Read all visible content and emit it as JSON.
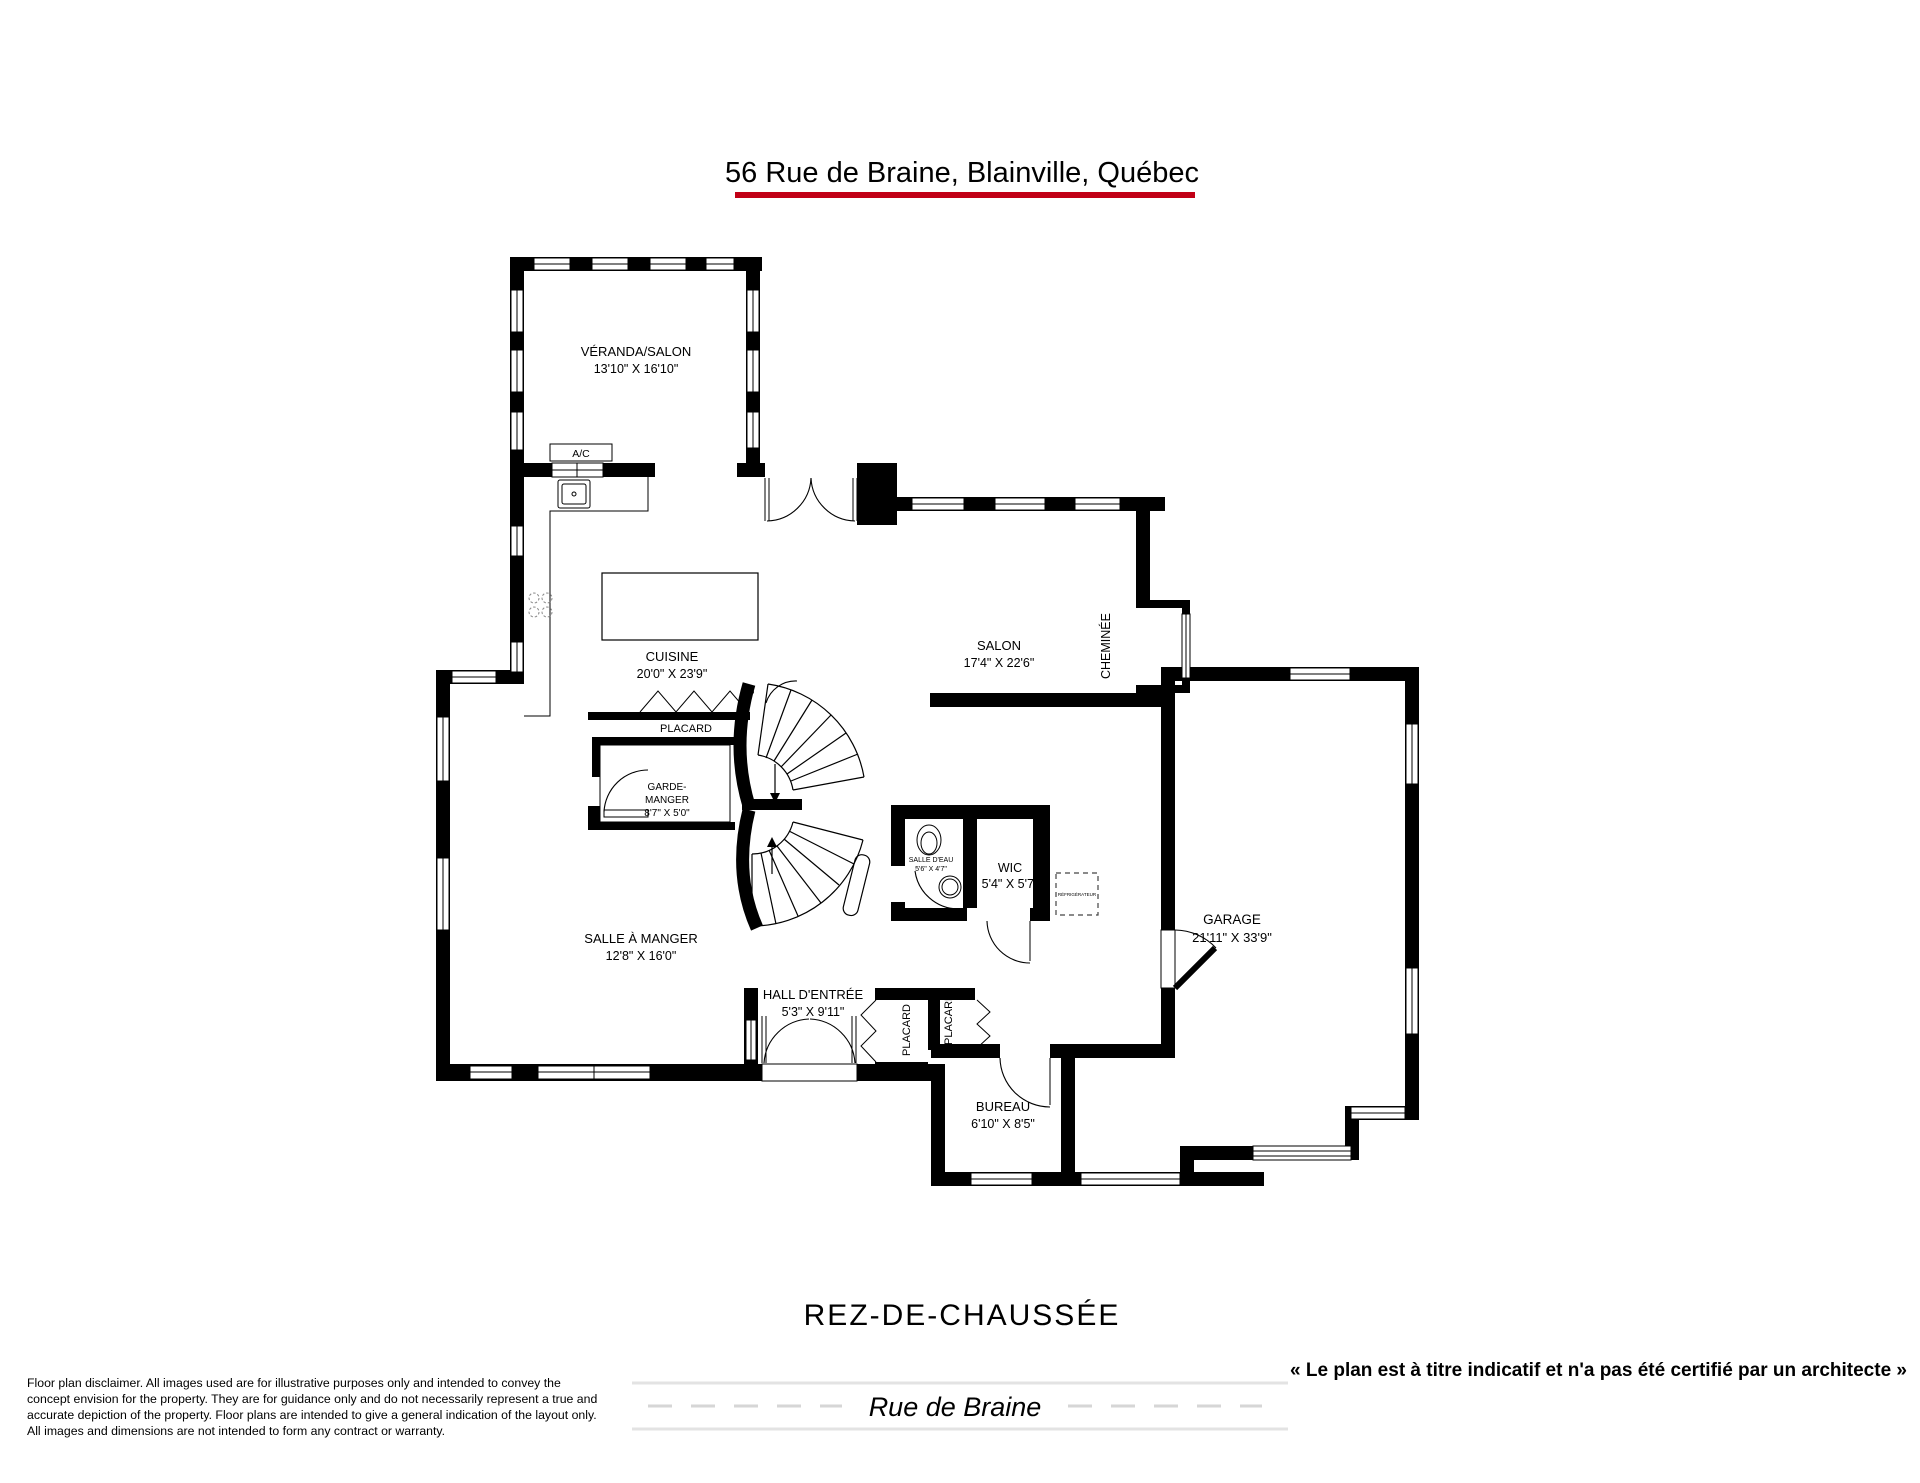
{
  "title": "56 Rue de Braine, Blainville, Québec",
  "floor_label": "REZ-DE-CHAUSSÉE",
  "colors": {
    "accent_red": "#c10016",
    "wall_black": "#000000",
    "road_gray": "#d9d9d9"
  },
  "rooms": {
    "veranda": {
      "name": "VÉRANDA/SALON",
      "dims": "13'10\" X 16'10\""
    },
    "cuisine": {
      "name": "CUISINE",
      "dims": "20'0\" X 23'9\""
    },
    "salon": {
      "name": "SALON",
      "dims": "17'4\" X 22'6\""
    },
    "cheminee": {
      "name": "CHEMINÉE"
    },
    "placard_cuisine": {
      "name": "PLACARD"
    },
    "p_door": {
      "name": "P"
    },
    "garde_manger": {
      "line1": "GARDE-",
      "line2": "MANGER",
      "dims": "8'7\" X 5'0\""
    },
    "salle_a_manger": {
      "name": "SALLE À MANGER",
      "dims": "12'8\" X 16'0\""
    },
    "hall_entree": {
      "name": "HALL D'ENTRÉE",
      "dims": "5'3\" X 9'11\""
    },
    "salle_eau": {
      "name": "SALLE D'EAU",
      "dims": "5'6\" X 4'7\""
    },
    "wic": {
      "name": "WIC",
      "dims": "5'4\" X 5'7\""
    },
    "garage": {
      "name": "GARAGE",
      "dims": "21'11\" X 33'9\""
    },
    "placard_hall_1": {
      "name": "PLACARD"
    },
    "placard_hall_2": {
      "name": "PLACARD"
    },
    "bureau": {
      "name": "BUREAU",
      "dims": "6'10\" X 8'5\""
    },
    "ac_unit": {
      "name": "A/C"
    },
    "refrigerateur": {
      "name": "RÉFRIGÉRATEUR"
    }
  },
  "footer": {
    "quote": "« Le plan est à titre indicatif et n'a pas été certifié par un architecte »",
    "street_name": "Rue de Braine",
    "disclaimer_lines": [
      "Floor plan disclaimer. All images used are for illustrative purposes only and intended to convey the",
      "concept envision for the property. They are for guidance only and do not necessarily represent a true and",
      "accurate depiction of the property. Floor plans are intended to give a general indication of the layout only.",
      "All images and dimensions are not intended to form any contract or warranty."
    ]
  }
}
